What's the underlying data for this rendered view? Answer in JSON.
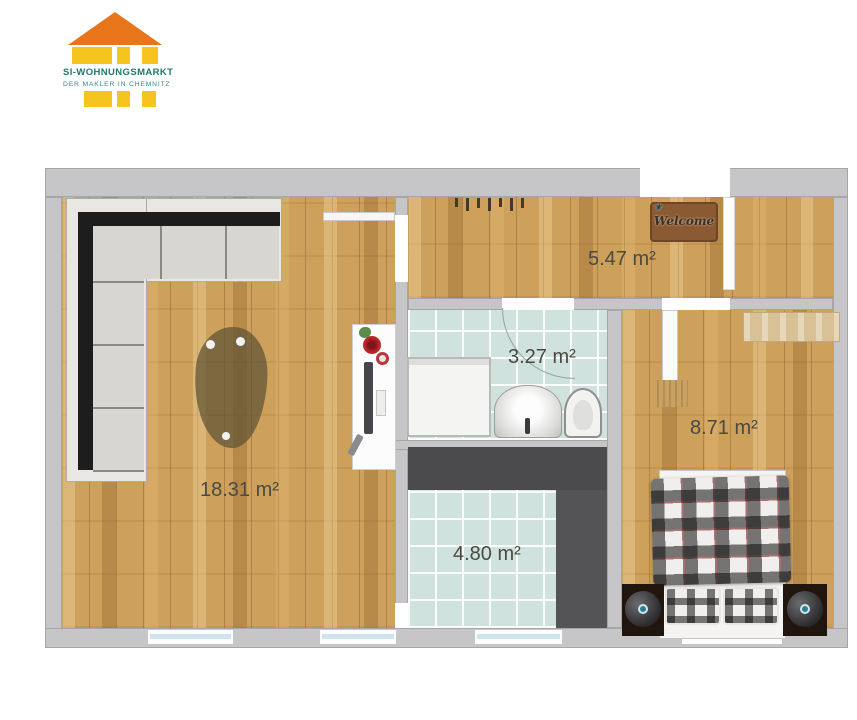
{
  "logo": {
    "title": "SI-WOHNUNGSMARKT",
    "subtitle": "DER MAKLER IN CHEMNITZ",
    "colors": {
      "roof_orange": "#E8751A",
      "brick_yellow": "#F6C41E",
      "title_teal": "#1F7A6C",
      "subtitle_teal": "#2F8E7E"
    }
  },
  "floorplan": {
    "rooms": [
      {
        "name": "living-room",
        "label": "18.31 m²"
      },
      {
        "name": "hallway",
        "label": "5.47 m²"
      },
      {
        "name": "bathroom",
        "label": "3.27 m²"
      },
      {
        "name": "hallway-lower",
        "label": "4.80 m²"
      },
      {
        "name": "bedroom",
        "label": "8.71 m²"
      }
    ],
    "doormat_text": "Welcome",
    "colors": {
      "wall_gray": "#C6C6C8",
      "wood_floor": "#CDA05B",
      "tile_floor": "#CFE2DE",
      "wardrobe_dark": "#4B4B4D",
      "label_text": "#4A4A41"
    }
  }
}
